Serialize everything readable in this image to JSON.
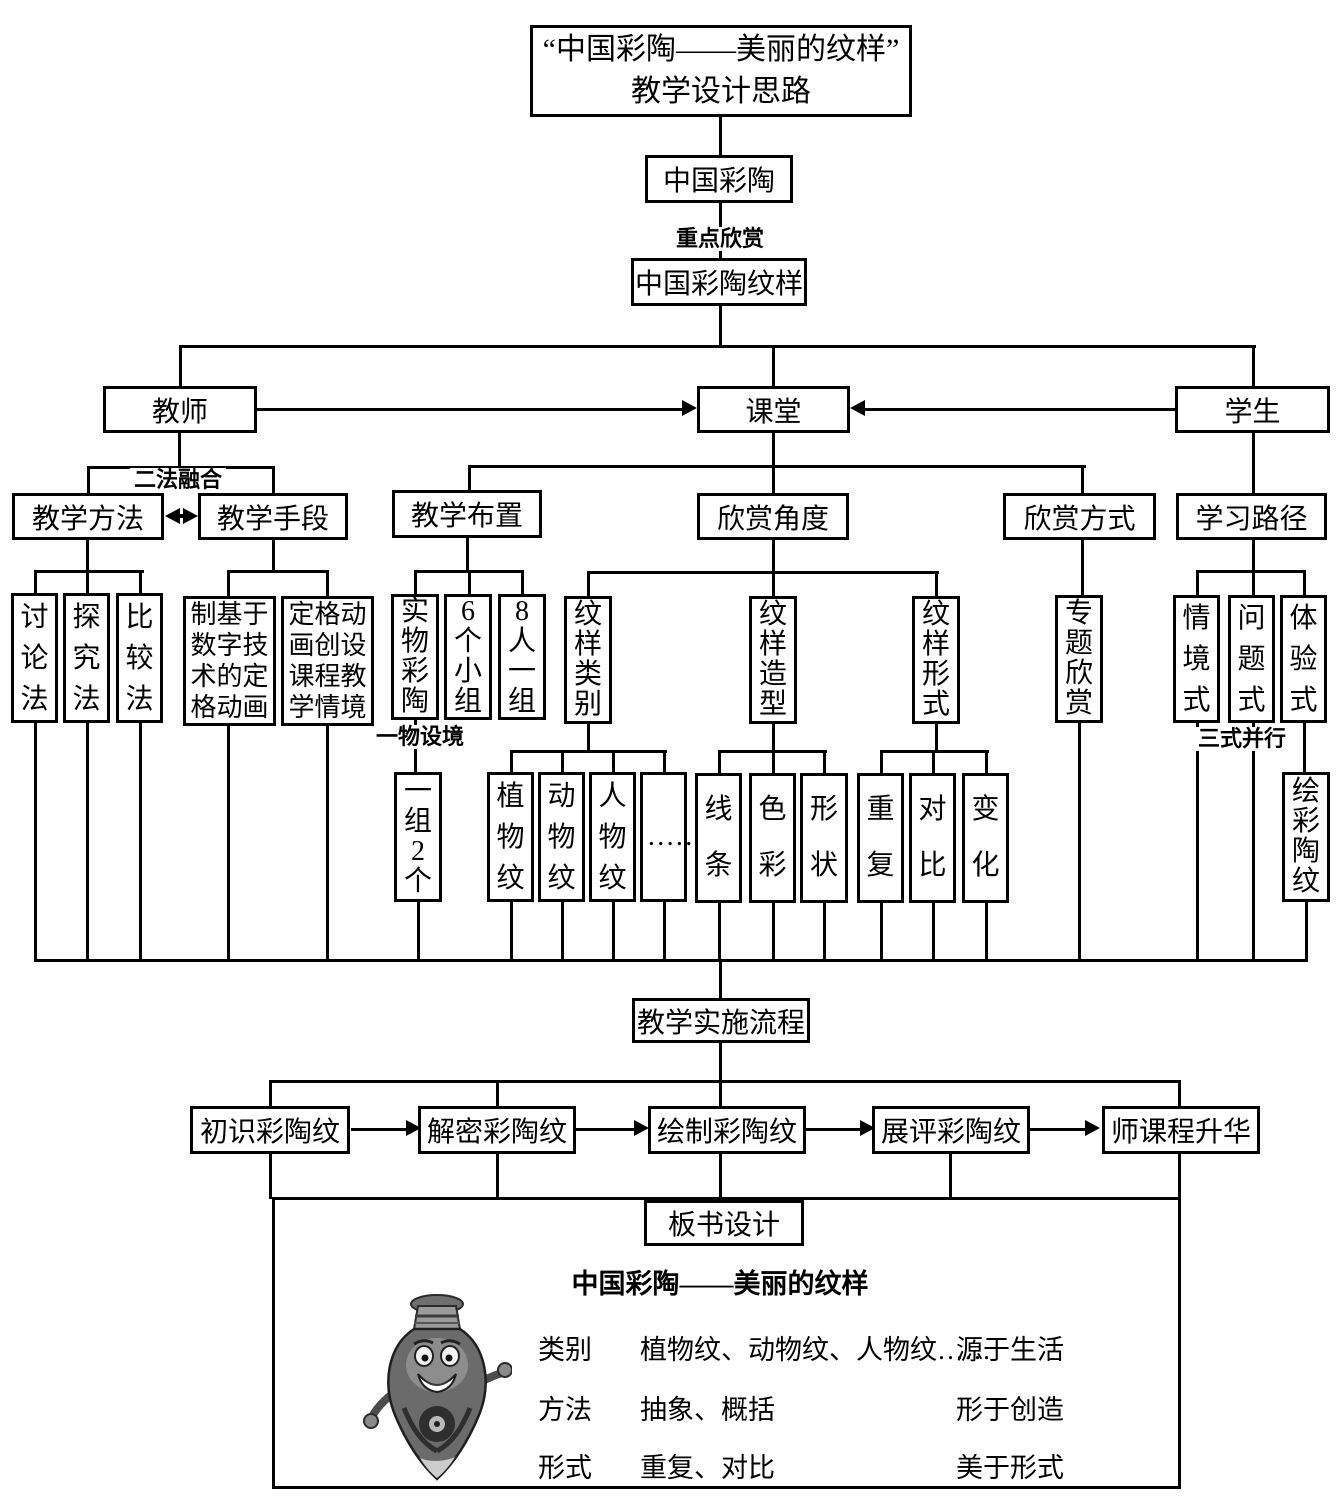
{
  "diagram": {
    "title": {
      "line1": "“中国彩陶——美丽的纹样”",
      "line2": "教学设计思路"
    },
    "nodes": {
      "zhongguo_caitao": "中国彩陶",
      "caitao_wenyang": "中国彩陶纹样",
      "jiaoshi": "教师",
      "ketang": "课堂",
      "xuesheng": "学生",
      "jiaoxue_fangfa": "教学方法",
      "jiaoxue_shouduan": "教学手段",
      "jiaoxue_buzhi": "教学布置",
      "xinshang_jiaodu": "欣赏角度",
      "xinshang_fangshi": "欣赏方式",
      "xuexi_lujing": "学习路径",
      "taolunfa": "讨论法",
      "tanjiufa": "探究法",
      "bijiaofa": "比较法",
      "zhi_dingge_donghua": "制基于数字技术的定格动画",
      "dingge_qingjing": "定格动画创设课程教学情境",
      "shiwu_caitao": "实物彩陶",
      "liuge_xiaozu": "6个小组",
      "baren_yizu": "8人一组",
      "wenyang_leibie": "纹样类别",
      "wenyang_zaoxing": "纹样造型",
      "wenyang_xingshi": "纹样形式",
      "zhuanti_xinshang": "专题欣赏",
      "qingjingshi": "情境式",
      "wentishi": "问题式",
      "tiyanshi": "体验式",
      "yizu_2ge": "一组2个",
      "zhiwuwen": "植物纹",
      "dongwuwen": "动物纹",
      "renwuwen": "人物纹",
      "ellipsis": "……",
      "xiantiao": "线条",
      "secai": "色彩",
      "xingzhuang": "形状",
      "chongfu": "重复",
      "duibi": "对比",
      "bianhua": "变化",
      "hui_caitaowen": "绘彩陶纹",
      "jiaoxue_shishi_liucheng": "教学实施流程",
      "chushi_caitaowen": "初识彩陶纹",
      "jiemi_caitaowen": "解密彩陶纹",
      "huizhi_caitaowen": "绘制彩陶纹",
      "zhanping_caitaowen": "展评彩陶纹",
      "shi_kecheng_shenghua": "师课程升华",
      "banshu_sheji": "板书设计"
    },
    "labels": {
      "zhongdian_xinshang": "重点欣赏",
      "erfa_ronghe": "二法融合",
      "yiwu_shejing": "一物设境",
      "sanshi_bingxing": "三式并行"
    },
    "board": {
      "title": "中国彩陶——美丽的纹样",
      "rows": [
        {
          "label": "类别",
          "value": "植物纹、动物纹、人物纹……",
          "note": "源于生活"
        },
        {
          "label": "方法",
          "value": "抽象、概括",
          "note": "形于创造"
        },
        {
          "label": "形式",
          "value": "重复、对比",
          "note": "美于形式"
        }
      ]
    },
    "colors": {
      "line": "#000000",
      "box_border": "#000000",
      "background": "#ffffff"
    }
  }
}
